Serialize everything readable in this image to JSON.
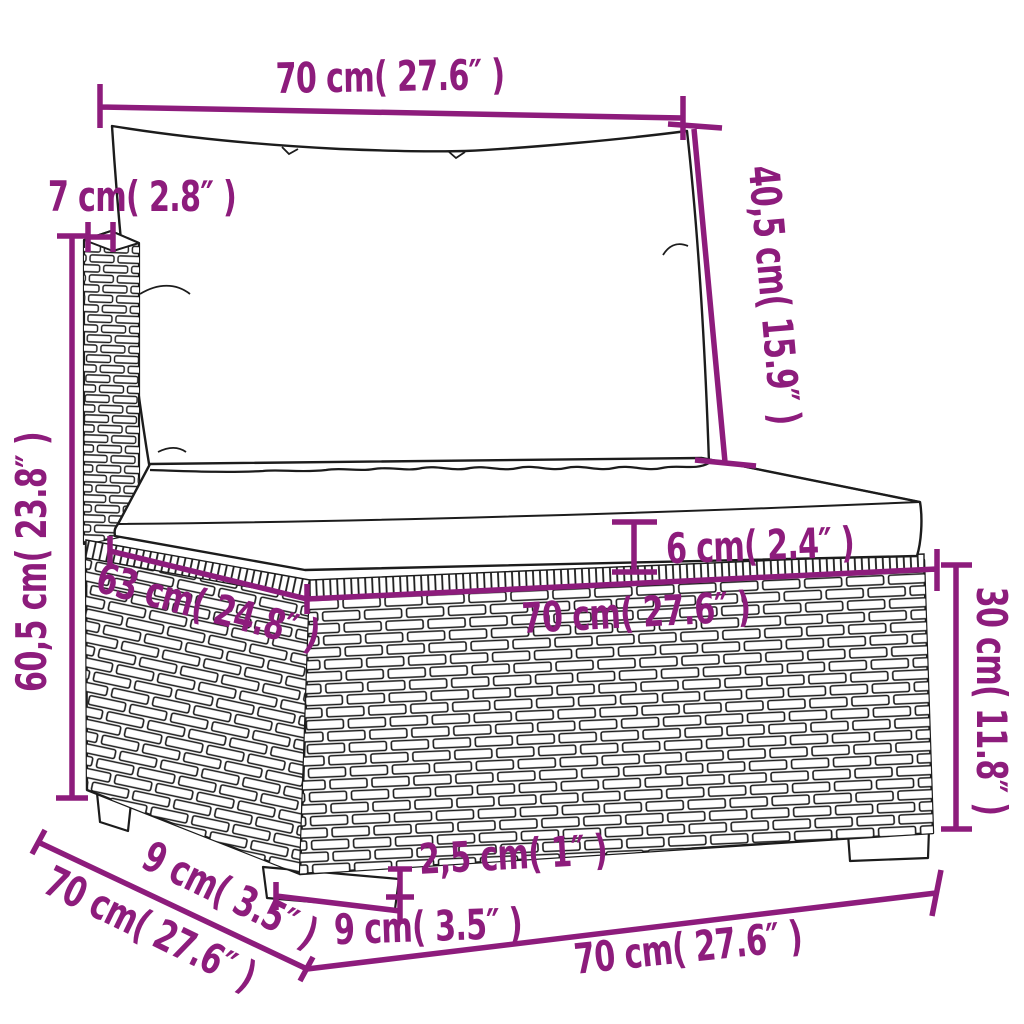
{
  "diagram": {
    "kind": "product-dimension-diagram",
    "subject": "poly-rattan sofa section with back and seat cushion",
    "accent_color": "#8d1c7c",
    "outline_color": "#1c1c1c",
    "background_color": "#ffffff",
    "dims": {
      "back_width": "70 cm( 27.6″ )",
      "post_width": "7 cm( 2.8″ )",
      "total_height": "60,5 cm( 23.8″ )",
      "back_cushion_height": "40,5 cm( 15.9″ )",
      "seat_cushion_thickness": "6 cm( 2.4″ )",
      "seat_depth": "63 cm( 24.8″ )",
      "seat_width": "70 cm( 27.6″ )",
      "base_height": "30 cm( 11.8″ )",
      "leg_height": "2,5 cm( 1″ )",
      "front_leg_depth": "9 cm( 3.5″ )",
      "side_leg_depth": "9 cm( 3.5″ )",
      "total_depth": "70 cm( 27.6″ )",
      "base_width": "70 cm( 27.6″ )"
    }
  }
}
